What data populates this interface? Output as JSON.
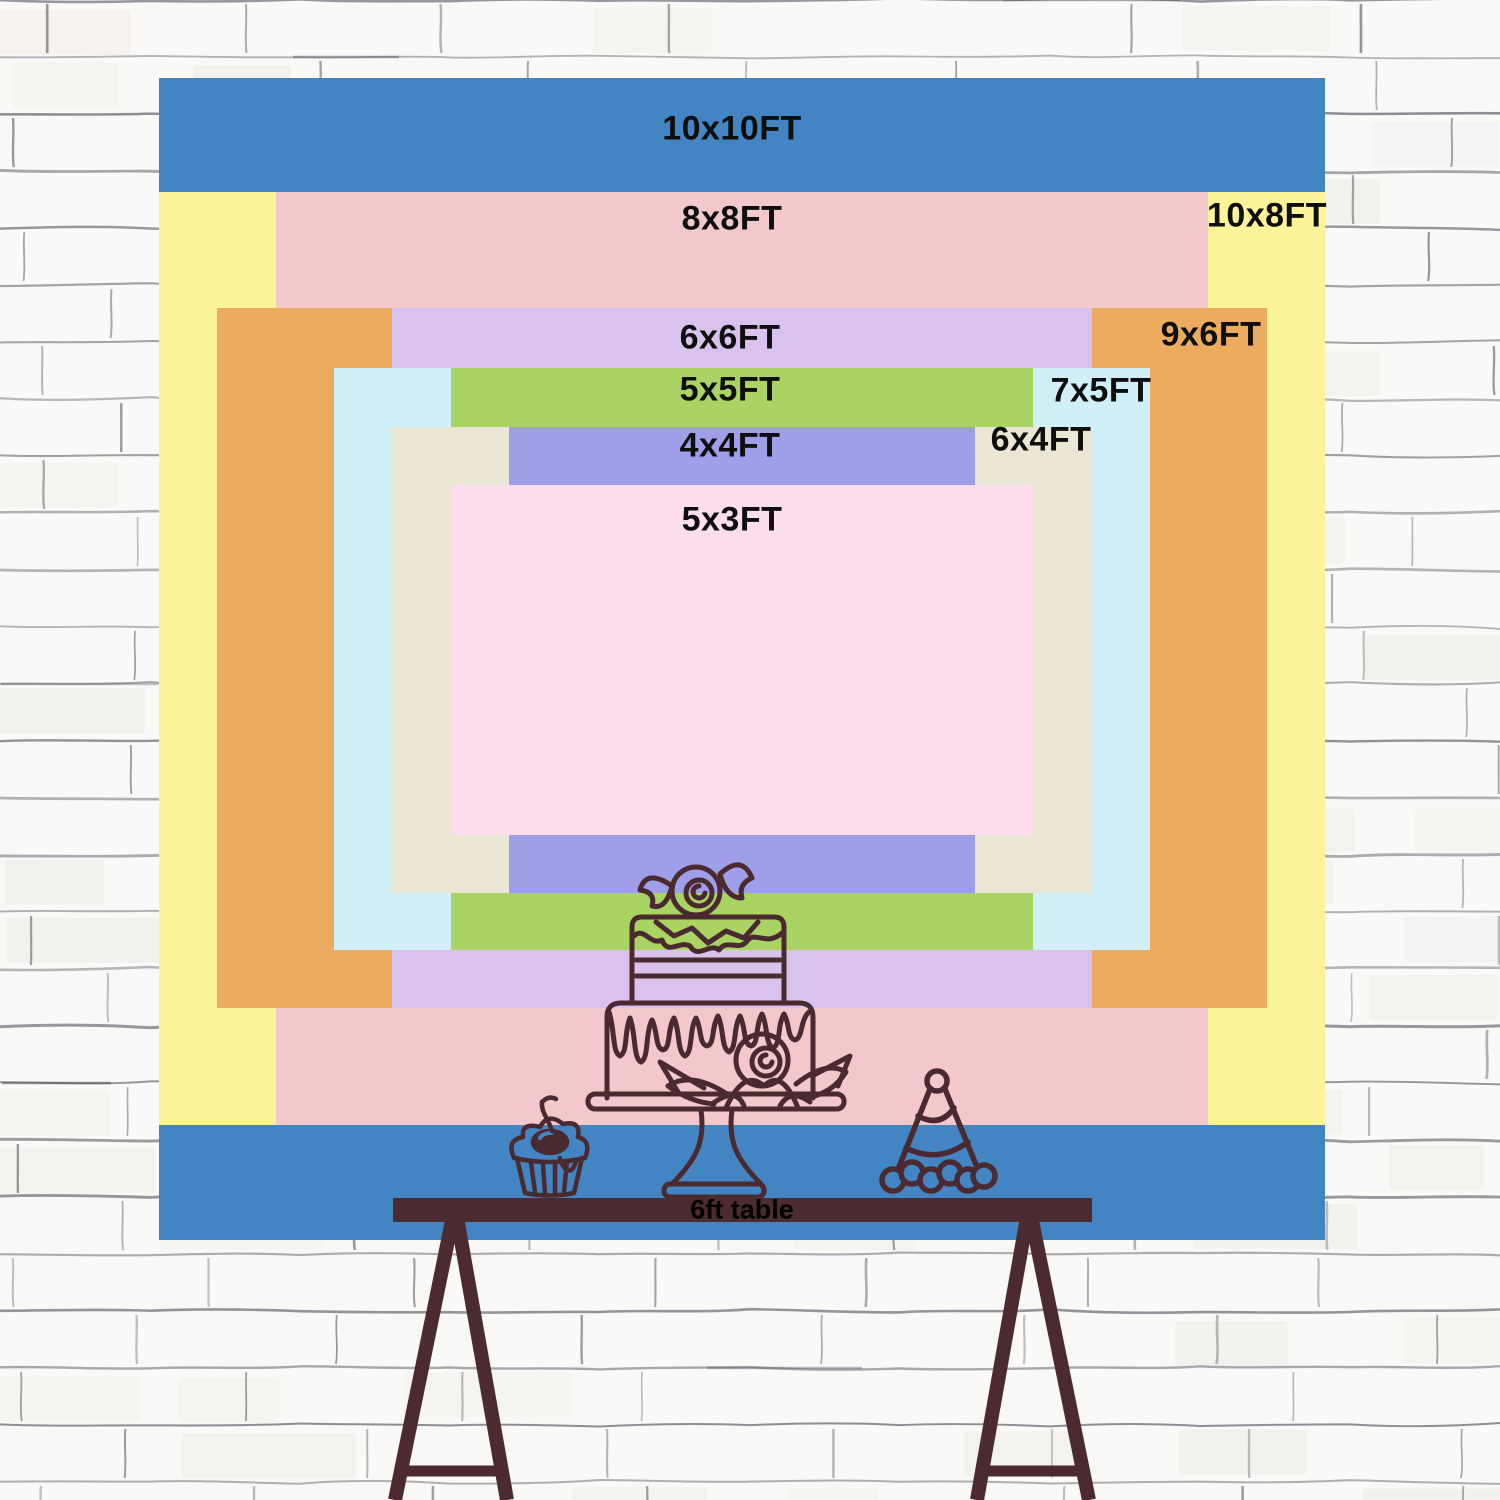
{
  "title": "Backdrop size comparison chart",
  "backdrop": {
    "pixels_per_foot": 116.5,
    "layers": [
      {
        "id": "10x10",
        "label": "10x10FT",
        "width_ft": 10,
        "height_ft": 10,
        "color": "#4385c3",
        "rect": {
          "x": 159,
          "y": 78,
          "w": 1166,
          "h": 1162
        },
        "label_pos": {
          "x": 732,
          "y": 129
        }
      },
      {
        "id": "10x8",
        "label": "10x8FT",
        "width_ft": 10,
        "height_ft": 8,
        "color": "#fdf399",
        "rect": {
          "x": 159,
          "y": 192,
          "w": 1166,
          "h": 933
        },
        "label_pos": {
          "x": 1267,
          "y": 216
        }
      },
      {
        "id": "8x8",
        "label": "8x8FT",
        "width_ft": 8,
        "height_ft": 8,
        "color": "#f2c8ca",
        "rect": {
          "x": 276,
          "y": 192,
          "w": 932,
          "h": 933
        },
        "label_pos": {
          "x": 732,
          "y": 219
        }
      },
      {
        "id": "9x6",
        "label": "9x6FT",
        "width_ft": 9,
        "height_ft": 6,
        "color": "#ecac60",
        "rect": {
          "x": 217,
          "y": 308,
          "w": 1050,
          "h": 700
        },
        "label_pos": {
          "x": 1211,
          "y": 335
        }
      },
      {
        "id": "6x6",
        "label": "6x6FT",
        "width_ft": 6,
        "height_ft": 6,
        "color": "#d9c2ee",
        "rect": {
          "x": 392,
          "y": 308,
          "w": 700,
          "h": 700
        },
        "label_pos": {
          "x": 730,
          "y": 338
        }
      },
      {
        "id": "7x5",
        "label": "7x5FT",
        "width_ft": 7,
        "height_ft": 5,
        "color": "#d0eff8",
        "rect": {
          "x": 334,
          "y": 368,
          "w": 816,
          "h": 582
        },
        "label_pos": {
          "x": 1101,
          "y": 391
        }
      },
      {
        "id": "5x5",
        "label": "5x5FT",
        "width_ft": 5,
        "height_ft": 5,
        "color": "#a9d464",
        "rect": {
          "x": 451,
          "y": 368,
          "w": 582,
          "h": 582
        },
        "label_pos": {
          "x": 730,
          "y": 390
        }
      },
      {
        "id": "6x4",
        "label": "6x4FT",
        "width_ft": 6,
        "height_ft": 4,
        "color": "#ece6d5",
        "rect": {
          "x": 392,
          "y": 427,
          "w": 700,
          "h": 466
        },
        "label_pos": {
          "x": 1041,
          "y": 440
        }
      },
      {
        "id": "4x4",
        "label": "4x4FT",
        "width_ft": 4,
        "height_ft": 4,
        "color": "#9f9ee9",
        "rect": {
          "x": 509,
          "y": 427,
          "w": 466,
          "h": 466
        },
        "label_pos": {
          "x": 730,
          "y": 446
        }
      },
      {
        "id": "5x3",
        "label": "5x3FT",
        "width_ft": 5,
        "height_ft": 3,
        "color": "#fcdeee",
        "rect": {
          "x": 451,
          "y": 485,
          "w": 582,
          "h": 350
        },
        "label_pos": {
          "x": 732,
          "y": 520
        }
      }
    ]
  },
  "table": {
    "label": "6ft table",
    "wood_color": "#4c2b30",
    "label_color": "#000000"
  },
  "artwork": {
    "stroke_color": "#4a2a30",
    "items": [
      "tiered-cake-line-art",
      "cupcake-with-cherry-line-art",
      "party-hat-line-art"
    ]
  },
  "wall": {
    "base_color": "#faf9f7",
    "mortar_line_color": "#70707a",
    "shade_color": "#efede9"
  }
}
